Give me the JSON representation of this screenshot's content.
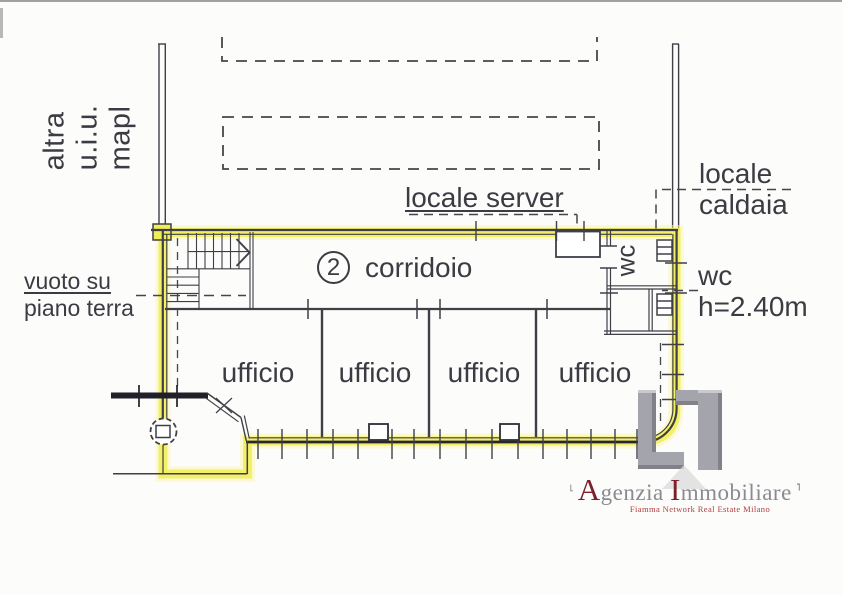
{
  "plan": {
    "left_vertical_label": "altra u.i.u. mapl",
    "vuoto_line1": "vuoto su",
    "vuoto_line2": "piano terra",
    "server_label": "locale server",
    "caldaia_line1": "locale",
    "caldaia_line2": "caldaia",
    "wc_height_line1": "wc",
    "wc_height_line2": "h=2.40m",
    "wc_room_label": "wc",
    "unit_number": "2",
    "corridor_label": "corridoio",
    "offices": [
      "ufficio",
      "ufficio",
      "ufficio",
      "ufficio"
    ],
    "highlight_color": "#f1ed55",
    "line_color": "#3f3f48"
  },
  "logo": {
    "name_initial_1": "A",
    "name_rest_1": "genzia",
    "name_initial_2": "I",
    "name_rest_2": "mmobiliare",
    "tagline": "Fiamma Network Real Estate Milano",
    "accent_color": "#7e1f2c",
    "gray_color": "#8a8a92"
  }
}
